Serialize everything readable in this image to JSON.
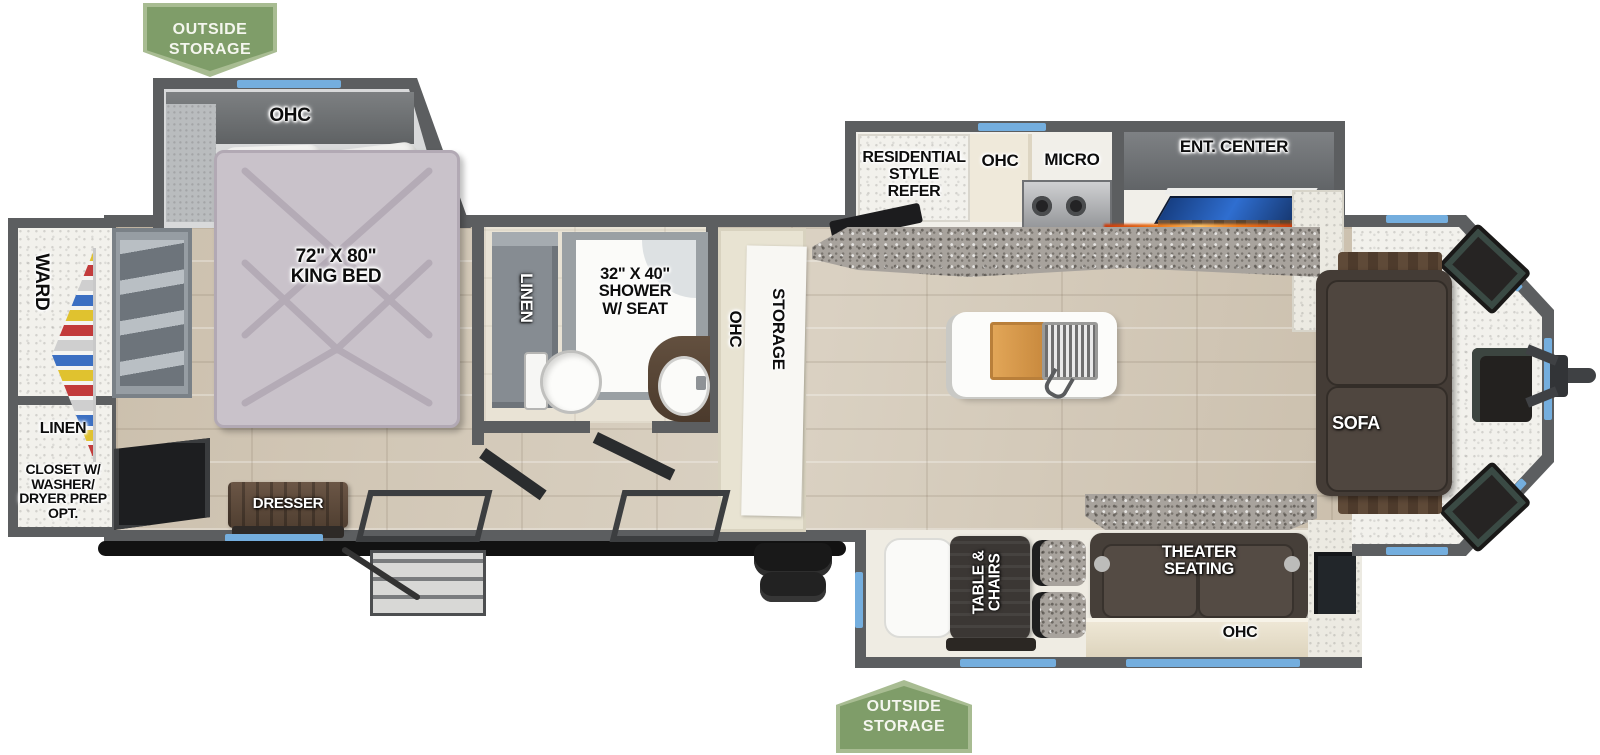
{
  "banners": {
    "outside_storage_top": "OUTSIDE\nSTORAGE",
    "outside_storage_bottom": "OUTSIDE\nSTORAGE"
  },
  "bedroom": {
    "ohc": "OHC",
    "king_bed": "72\" X 80\"\nKING BED",
    "dresser": "DRESSER"
  },
  "rear_closet": {
    "ward": "WARD",
    "linen": "LINEN",
    "closet_opt": "CLOSET W/\nWASHER/\nDRYER PREP\nOPT."
  },
  "bathroom": {
    "linen": "LINEN",
    "shower": "32\" X 40\"\nSHOWER\nW/ SEAT"
  },
  "hallway": {
    "ohc": "OHC",
    "storage": "STORAGE"
  },
  "kitchen": {
    "refer": "RESIDENTIAL\nSTYLE\nREFER",
    "ohc": "OHC",
    "micro": "MICRO"
  },
  "living_room": {
    "ent_center": "ENT. CENTER",
    "fireplace": "FIREPLACE",
    "sofa": "SOFA",
    "theater_seating": "THEATER\nSEATING",
    "ohc": "OHC"
  },
  "dinette": {
    "table_chairs": "TABLE &\nCHAIRS"
  },
  "colors": {
    "wall_gray": "#5c5e60",
    "window_blue": "#74aede",
    "banner_green": "#7f9d69",
    "banner_border_green": "#a8bc92",
    "floor_wood": "#d5cbba",
    "bed_fabric": "#c9c2ca",
    "sofa_brown": "#443c36",
    "counter_granite": "#a8a39d",
    "fireplace_flame": "#f07b1a"
  }
}
